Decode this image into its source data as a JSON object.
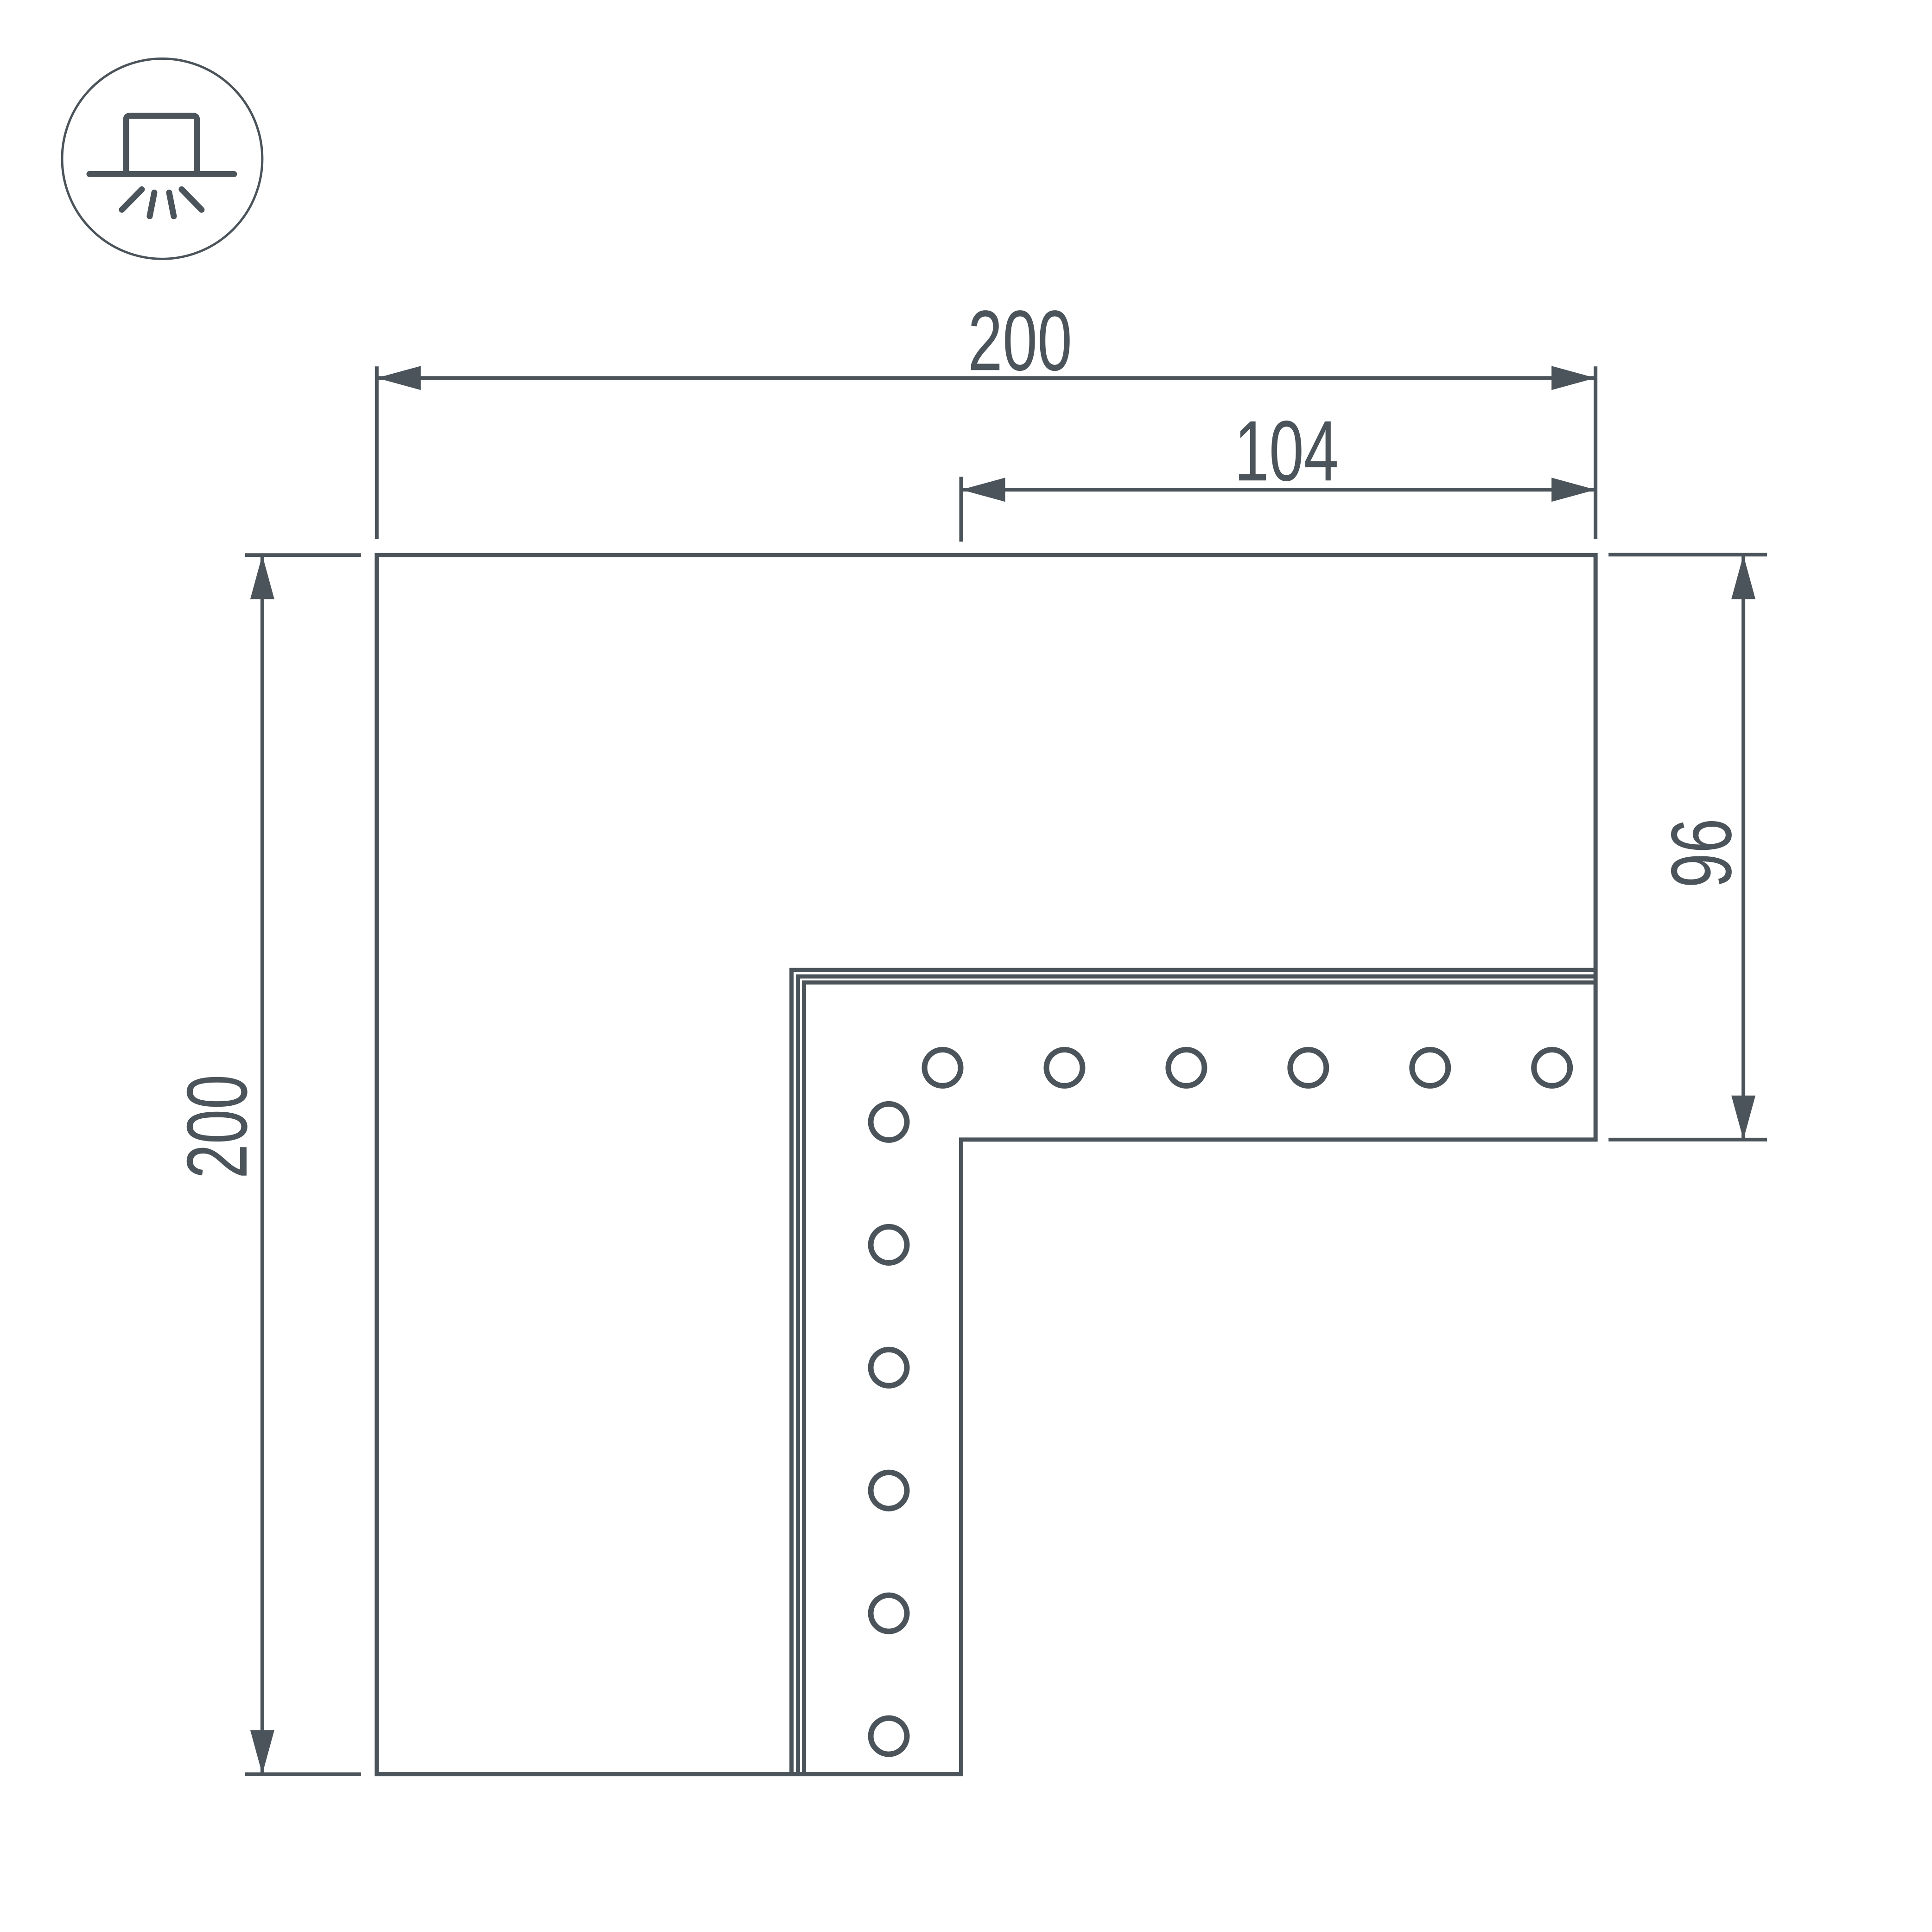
{
  "drawing": {
    "type": "technical-dimension-drawing",
    "view": "corner-connector-top-view",
    "hole_count": 12,
    "line_color": "#4b545a",
    "background_color": "#ffffff"
  },
  "icon": {
    "name": "recessed-downlight-icon"
  },
  "dimensions": {
    "top_width": {
      "label": "200"
    },
    "top_inner_width": {
      "label": "104"
    },
    "left_height": {
      "label": "200"
    },
    "right_height": {
      "label": "96"
    }
  }
}
